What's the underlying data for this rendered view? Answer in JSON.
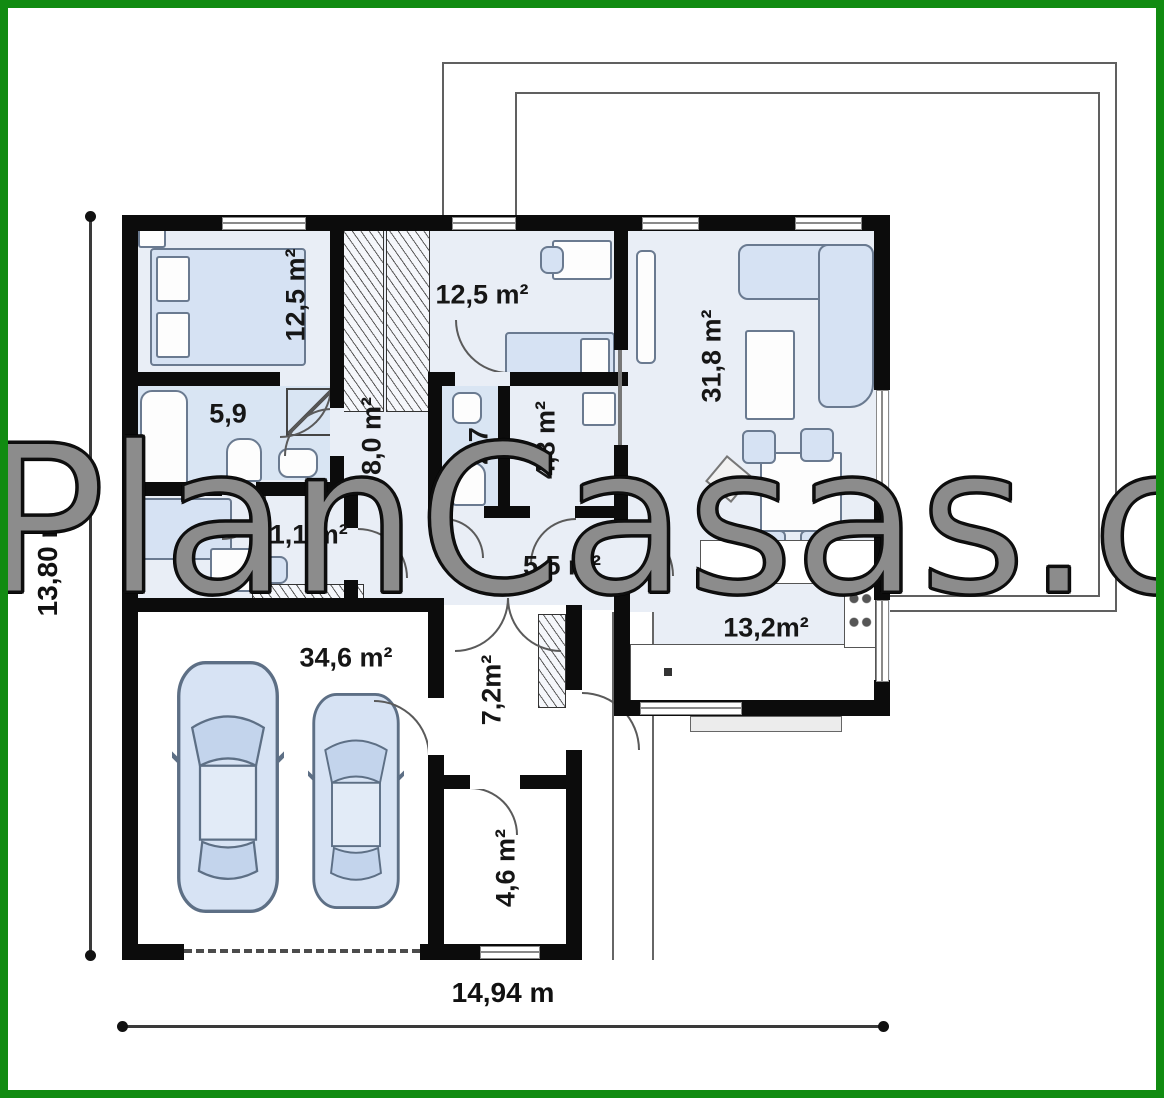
{
  "watermark": {
    "text": "PlanCasas.com"
  },
  "dimensions": {
    "height_label": "13,80 m",
    "width_label": "14,94 m"
  },
  "rooms": [
    {
      "id": "bedroom-1",
      "label": "12,5 m²"
    },
    {
      "id": "bedroom-2",
      "label": "12,5 m²"
    },
    {
      "id": "living-room",
      "label": "31,8 m²"
    },
    {
      "id": "bathroom",
      "label": "5,9"
    },
    {
      "id": "hall",
      "label": "8,0 m²"
    },
    {
      "id": "wc",
      "label": "2,7"
    },
    {
      "id": "storage",
      "label": "4,8 m²"
    },
    {
      "id": "office",
      "label": "11,1 m²"
    },
    {
      "id": "corridor",
      "label": "5,5 m²"
    },
    {
      "id": "kitchen",
      "label": "13,2m²"
    },
    {
      "id": "garage",
      "label": "34,6 m²"
    },
    {
      "id": "entry",
      "label": "7,2m²"
    },
    {
      "id": "utility",
      "label": "4,6 m²"
    }
  ],
  "colors": {
    "frame_green": "#118b11",
    "wall_black": "#0c0c0c",
    "floor_blue": "#e9eef6",
    "bath_blue": "#d9e5f3",
    "furniture_blue": "#d6e2f3"
  }
}
